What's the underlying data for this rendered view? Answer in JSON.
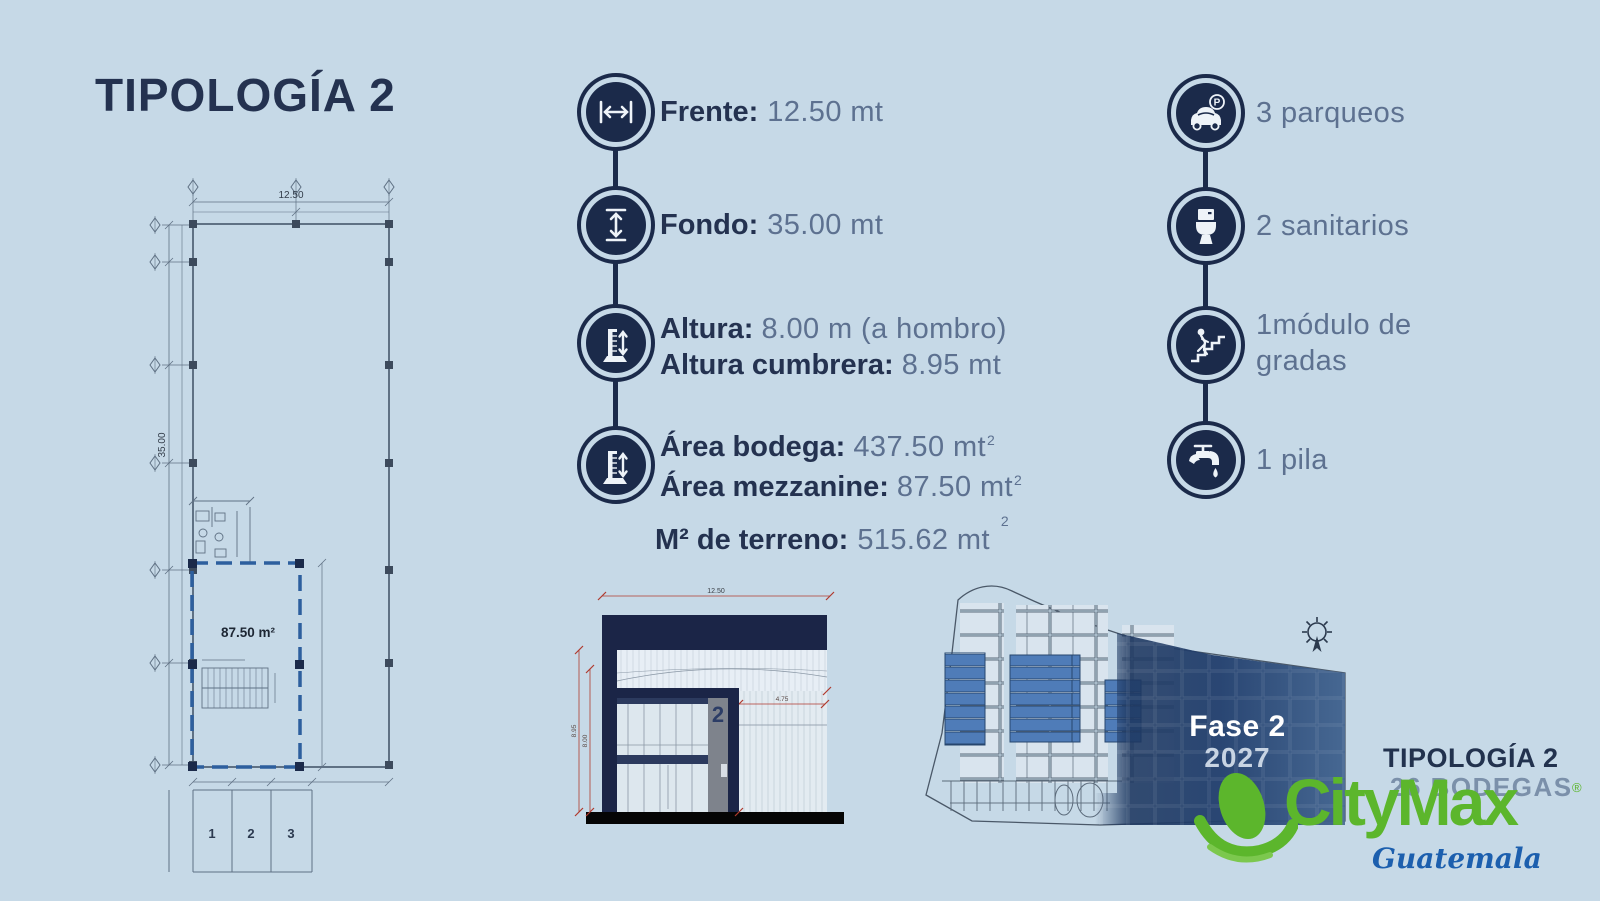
{
  "page": {
    "title": "TIPOLOGÍA 2",
    "background": "#c6d9e7"
  },
  "colors": {
    "navy": "#1b2a4a",
    "label_text": "#243250",
    "value_text": "#5d7190",
    "plan_dashed_blue": "#2d5f9e",
    "site_unit_blue": "#4f7cb8",
    "brand_green": "#5cb62c",
    "brand_blue": "#1c5fae",
    "dim_red": "#b03a2e"
  },
  "specs": [
    {
      "icon": "width-arrow-icon",
      "label": "Frente:",
      "value": "12.50 mt"
    },
    {
      "icon": "depth-arrow-icon",
      "label": "Fondo:",
      "value": "35.00 mt"
    },
    {
      "icon": "height-gauge-icon",
      "lines": [
        {
          "label": "Altura:",
          "value": "8.00 m (a hombro)"
        },
        {
          "label": "Altura cumbrera:",
          "value": "8.95 mt"
        }
      ]
    },
    {
      "icon": "area-gauge-icon",
      "lines": [
        {
          "label": "Área bodega:",
          "value": "437.50 mt",
          "sup": "2"
        },
        {
          "label": "Área mezzanine:",
          "value": "87.50 mt",
          "sup": "2"
        }
      ]
    }
  ],
  "terreno": {
    "label": "M² de terreno:",
    "value": "515.62 mt",
    "sup": "2"
  },
  "amenities": [
    {
      "icon": "parking-car-icon",
      "lines": [
        "3 parqueos"
      ]
    },
    {
      "icon": "toilet-icon",
      "lines": [
        "2 sanitarios"
      ]
    },
    {
      "icon": "stairs-person-icon",
      "lines": [
        "1módulo de",
        "gradas"
      ]
    },
    {
      "icon": "faucet-icon",
      "lines": [
        "1 pila"
      ]
    }
  ],
  "floorplan": {
    "top_dim": "12.50",
    "side_dim": "35.00",
    "mezzanine_area": "87.50 m²",
    "stalls": [
      "1",
      "2",
      "3"
    ]
  },
  "elevation": {
    "width_dim": "12.50",
    "door_dim": "4.75",
    "left_dim_outer": "8.95",
    "left_dim_inner": "8.00",
    "unit_number": "2"
  },
  "siteplan": {
    "phase": "Fase 2",
    "year": "2027"
  },
  "footer": {
    "typology": "TIPOLOGÍA 2",
    "units": "26 BODEGAS",
    "brand": "CityMax",
    "registered": "®",
    "country": "Guatemala"
  }
}
